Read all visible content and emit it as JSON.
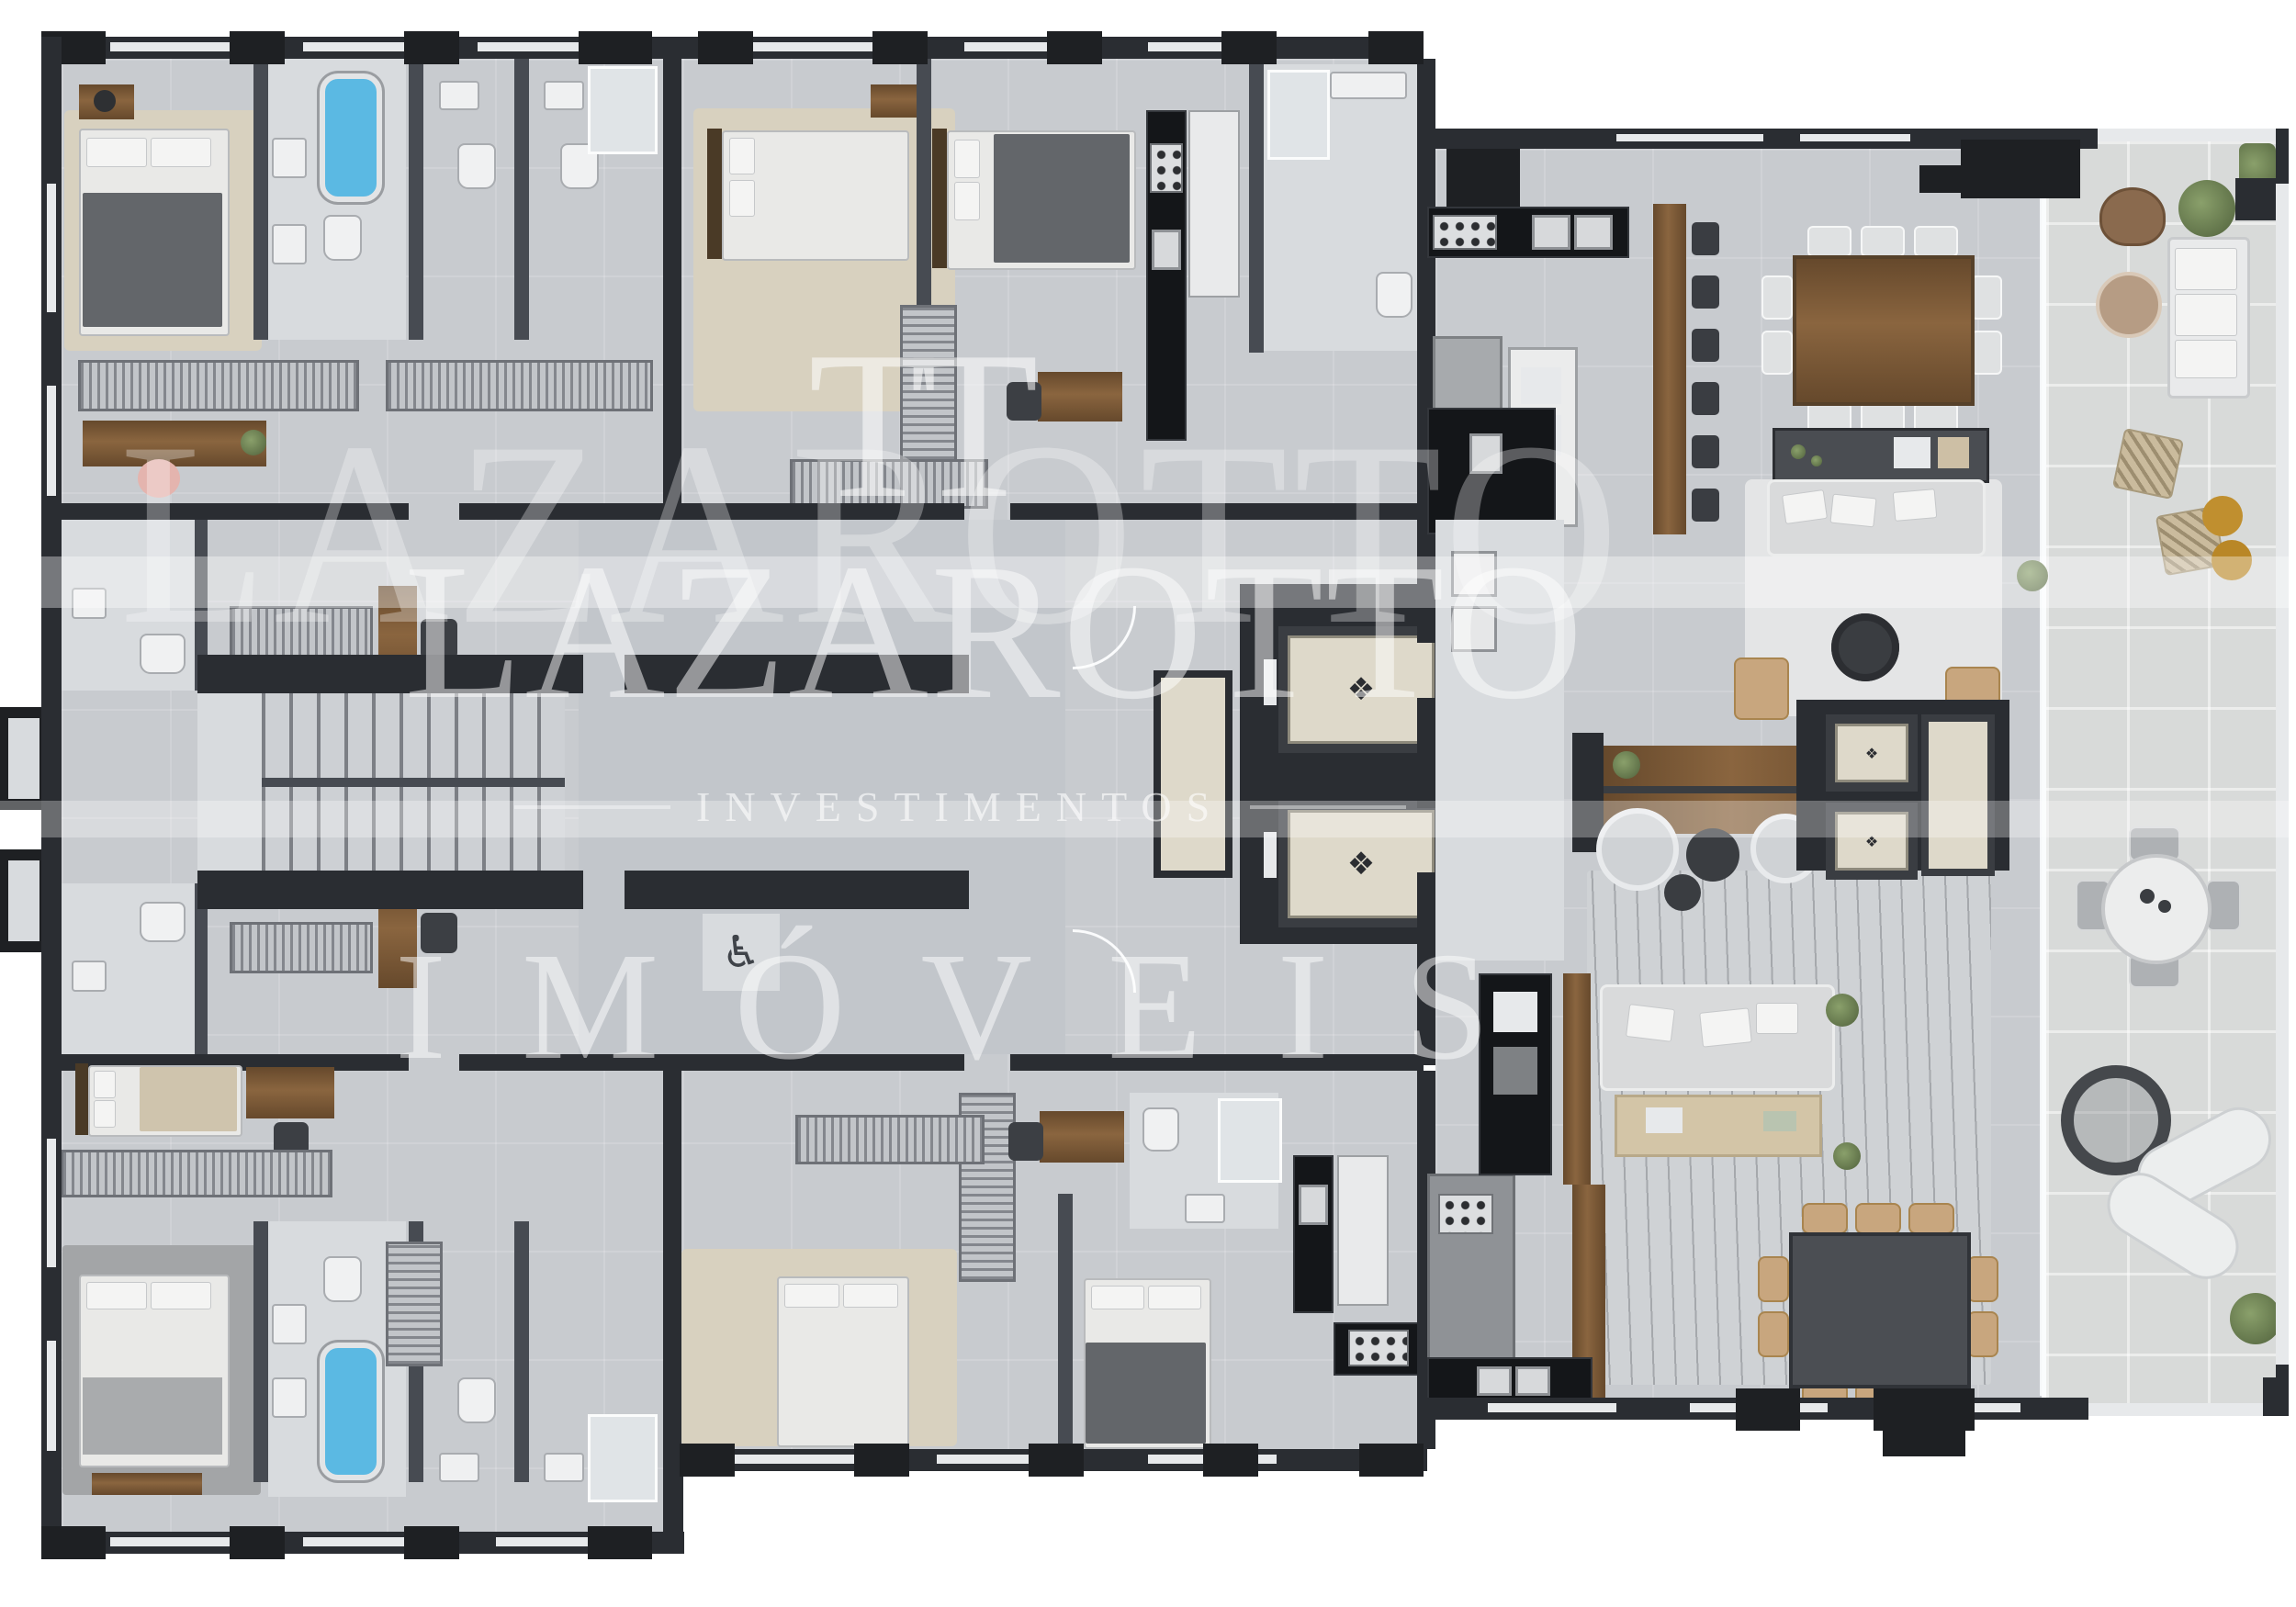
{
  "watermark": {
    "monogram": "TT",
    "brand_echo": "LAZAROTTO",
    "brand": "LAZAROTTO",
    "division": "INVESTIMENTOS",
    "product": "IMÓVEIS"
  },
  "icons": {
    "accessibility": "♿",
    "elevator_medallion": "❖",
    "foyer_medallion": "✦"
  },
  "palette": {
    "wall": "#2a2d32",
    "wallm": "#474b52",
    "pillar": "#1e2023",
    "sill": "#e7e9eb",
    "floor": "#c8cbcf",
    "floorL": "#d8dbde",
    "hall": "#c2c6cb",
    "terr": "#d8dad9",
    "wood": "#7b5a3a",
    "counter": "#141619",
    "water": "#5bb9e3",
    "cream": "#ded9ca",
    "tan": "#c8a67e",
    "green": "#6d8052"
  }
}
